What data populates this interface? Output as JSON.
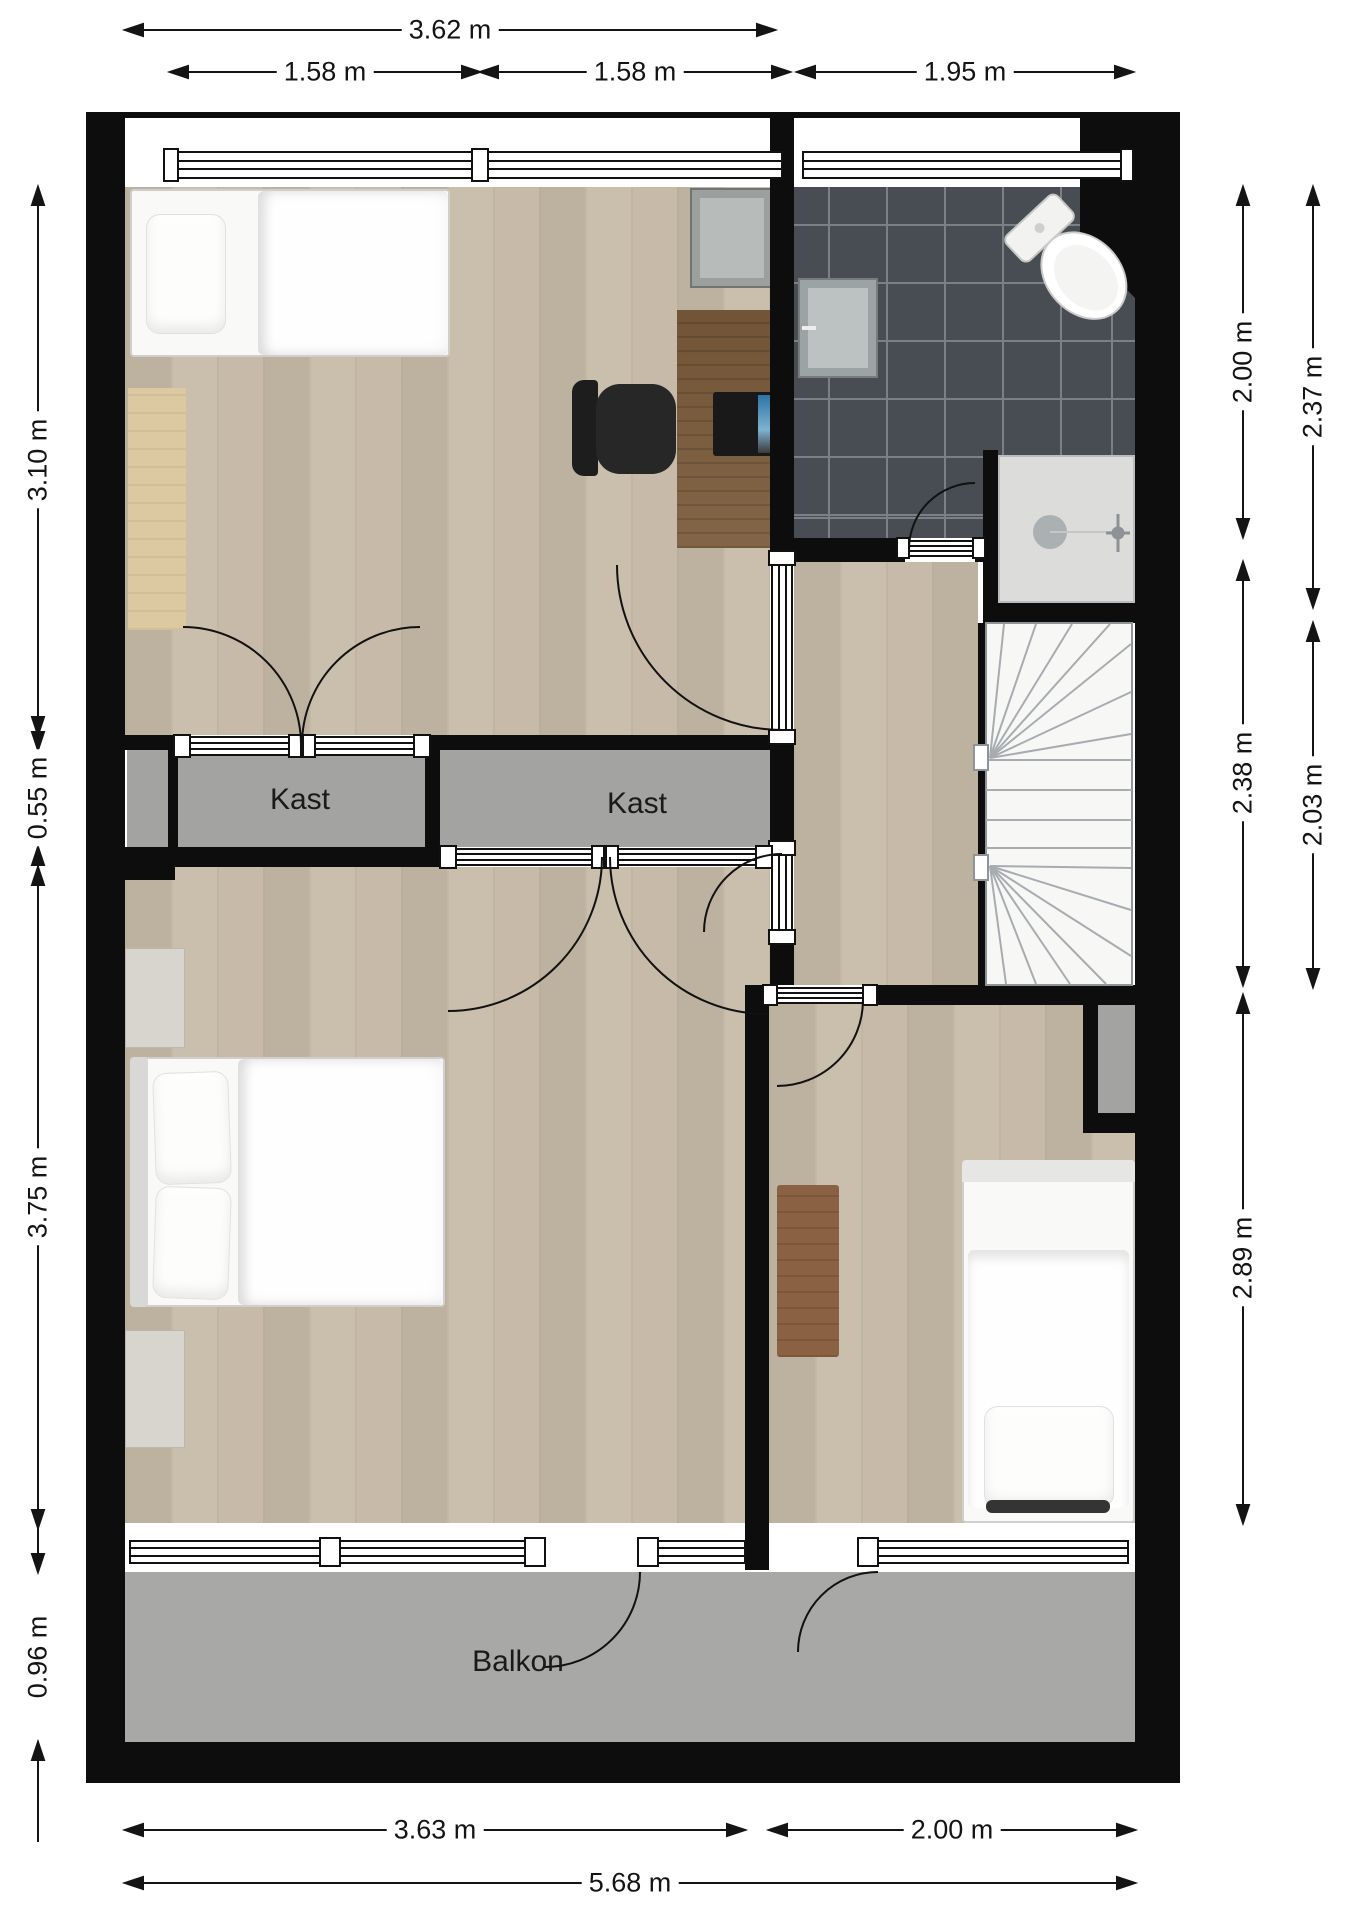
{
  "floorplan": {
    "type": "2d-floorplan-top-view",
    "dims_top": [
      {
        "label": "3.62 m"
      },
      {
        "label": "1.58 m"
      },
      {
        "label": "1.58 m"
      },
      {
        "label": "1.95 m"
      }
    ],
    "dims_left": [
      {
        "label": "3.10 m"
      },
      {
        "label": "0.55 m"
      },
      {
        "label": "3.75 m"
      },
      {
        "label": "0.96 m"
      }
    ],
    "dims_right_inner": [
      {
        "label": "2.00 m"
      },
      {
        "label": "2.38 m"
      },
      {
        "label": "2.89 m"
      }
    ],
    "dims_right_outer": [
      {
        "label": "2.37 m"
      },
      {
        "label": "2.03 m"
      }
    ],
    "dims_bottom": [
      {
        "label": "3.63 m"
      },
      {
        "label": "2.00 m"
      },
      {
        "label": "5.68 m"
      }
    ],
    "room_labels": [
      {
        "label": "Kast"
      },
      {
        "label": "Kast"
      },
      {
        "label": "Balkon"
      }
    ],
    "colors": {
      "wall": "#0d0d0d",
      "wood_floor": "#c7baa8",
      "bathroom_tile": "#484d53",
      "closet_gray": "#a3a3a1",
      "balcony_gray": "#a8a8a6",
      "desk_brown": "#7b5b3b",
      "rug_brown": "#8a6142"
    }
  }
}
